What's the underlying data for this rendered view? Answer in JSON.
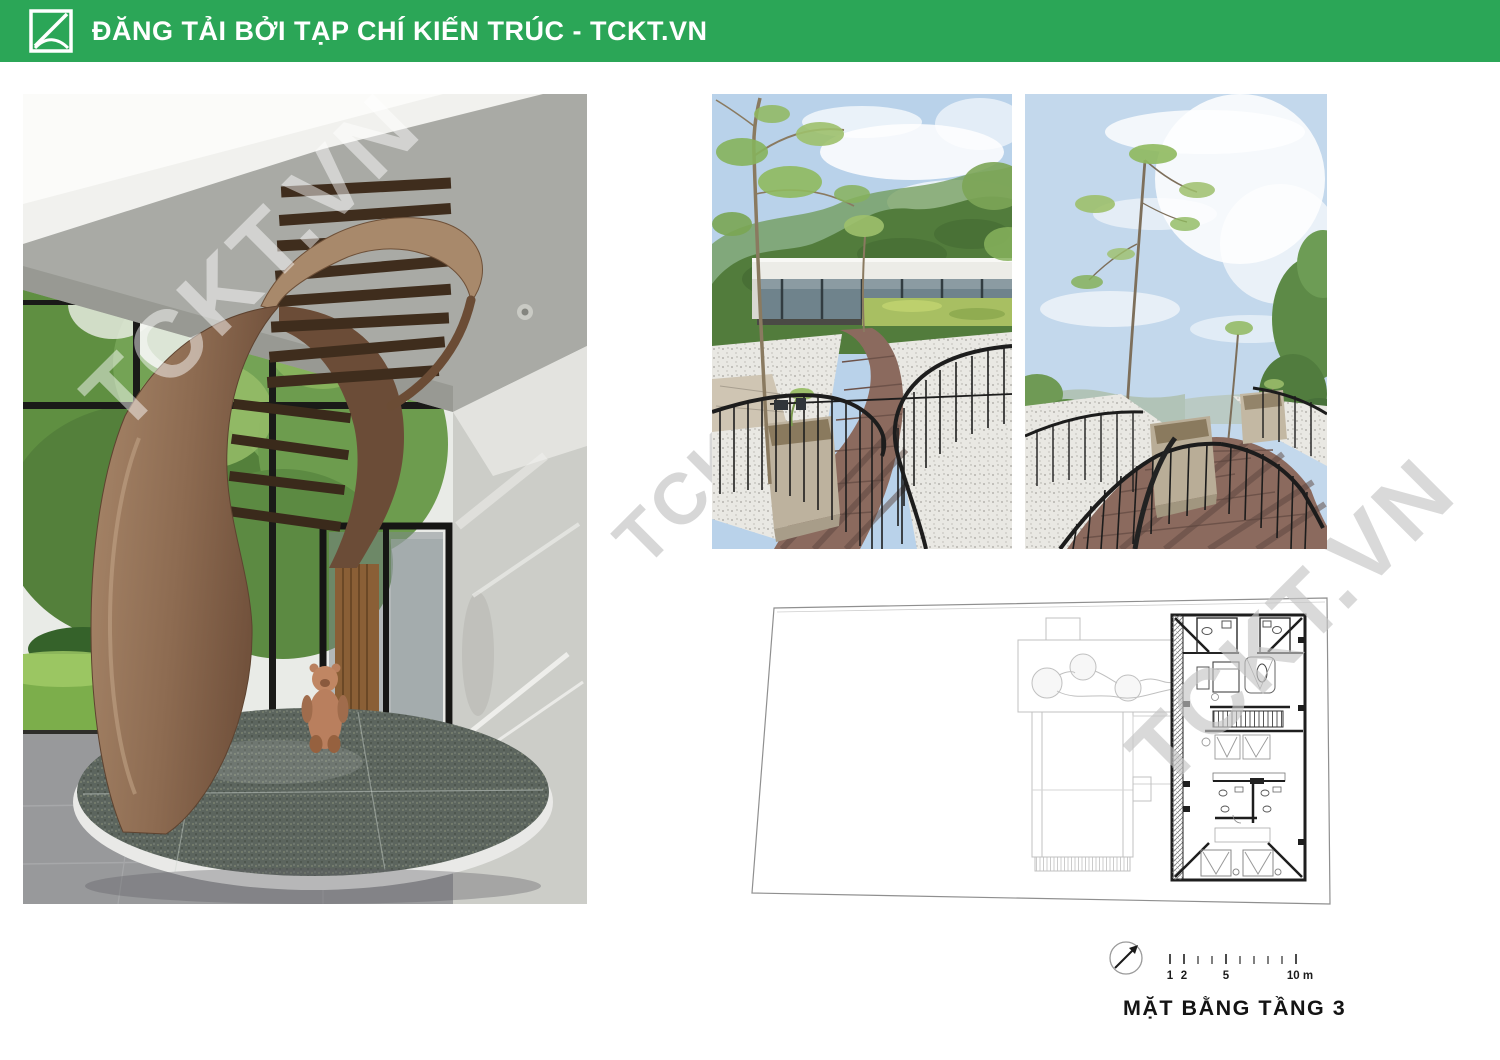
{
  "header": {
    "title": "ĐĂNG TẢI BỞI TẠP CHÍ KIẾN TRÚC - TCKT.VN",
    "bg_color": "#2BA657",
    "text_color": "#FFFFFF",
    "logo": "tckt-logo"
  },
  "watermark": {
    "text": "TCKT.VN",
    "gray_color": "#CDCDCD"
  },
  "photos": {
    "staircase": "spiral-staircase-interior-photo",
    "walkway_left": "rooftop-walkway-photo-1",
    "walkway_right": "rooftop-walkway-photo-2"
  },
  "plan": {
    "caption": "MẶT BẰNG TẦNG 3",
    "compass": "north-arrow-icon",
    "scale": {
      "labels": [
        "1",
        "2",
        "5",
        "10 m"
      ]
    }
  }
}
